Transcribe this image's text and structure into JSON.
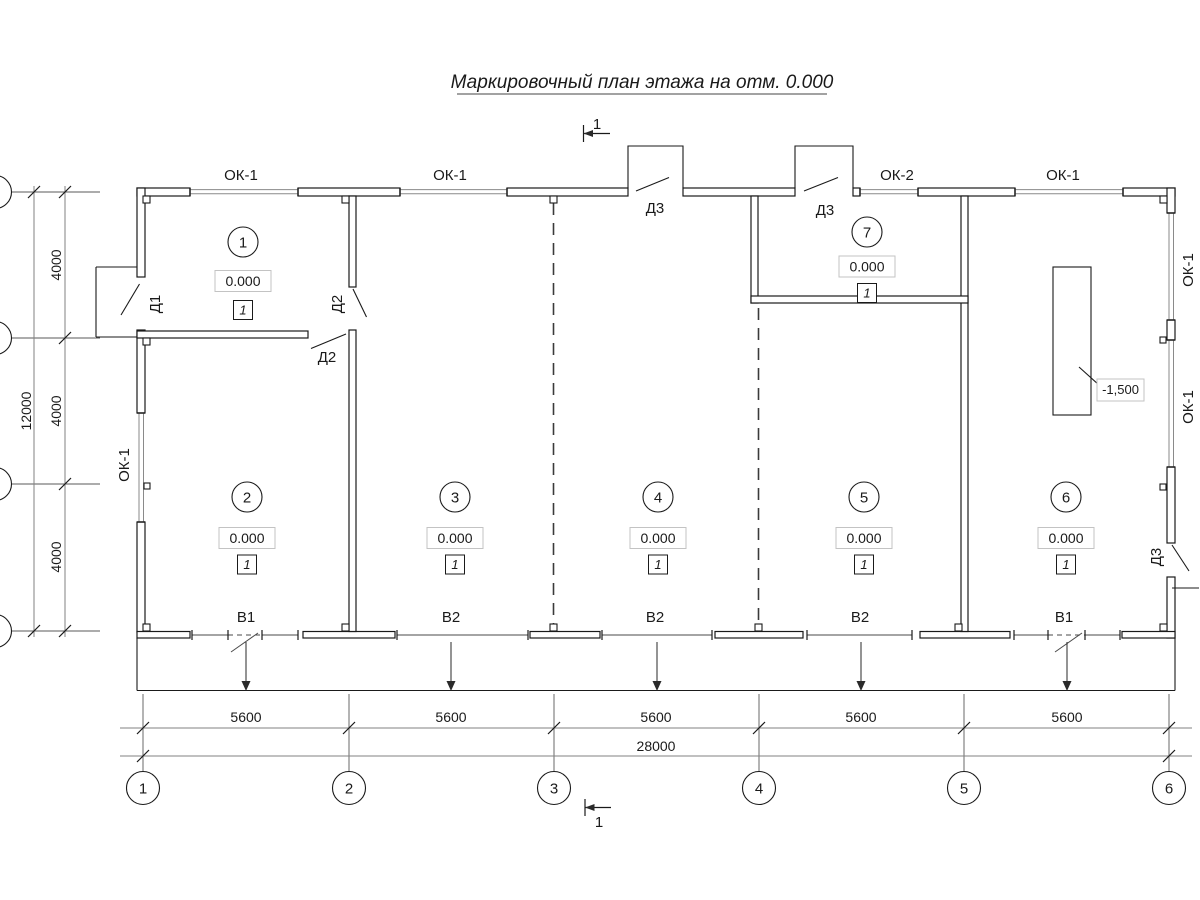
{
  "title": "Маркировочный план этажа на отм. 0.000",
  "section": {
    "top": "1",
    "bottom": "1"
  },
  "windows": {
    "top": [
      "ОК-1",
      "ОК-1",
      "ОК-2",
      "ОК-1"
    ],
    "left": "ОК-1",
    "right": [
      "ОК-1",
      "ОК-1"
    ]
  },
  "doors": {
    "d1": "Д1",
    "d2_upper": "Д2",
    "d2_lower": "Д2",
    "d3_vest1": "Д3",
    "d3_vest2": "Д3",
    "d3_side": "Д3"
  },
  "gates": [
    "В1",
    "В2",
    "В2",
    "В2",
    "В1"
  ],
  "rooms": [
    {
      "number": "1",
      "elevation": "0.000",
      "finish": "1"
    },
    {
      "number": "2",
      "elevation": "0.000",
      "finish": "1"
    },
    {
      "number": "3",
      "elevation": "0.000",
      "finish": "1"
    },
    {
      "number": "4",
      "elevation": "0.000",
      "finish": "1"
    },
    {
      "number": "5",
      "elevation": "0.000",
      "finish": "1"
    },
    {
      "number": "6",
      "elevation": "0.000",
      "finish": "1"
    },
    {
      "number": "7",
      "elevation": "0.000",
      "finish": "1"
    }
  ],
  "pit": {
    "elevation": "-1,500"
  },
  "dimensions": {
    "bottom_bays": [
      "5600",
      "5600",
      "5600",
      "5600",
      "5600"
    ],
    "bottom_total": "28000",
    "left_bays": [
      "4000",
      "4000",
      "4000"
    ],
    "left_total": "12000"
  },
  "grid": {
    "columns": [
      "1",
      "2",
      "3",
      "4",
      "5",
      "6"
    ]
  }
}
